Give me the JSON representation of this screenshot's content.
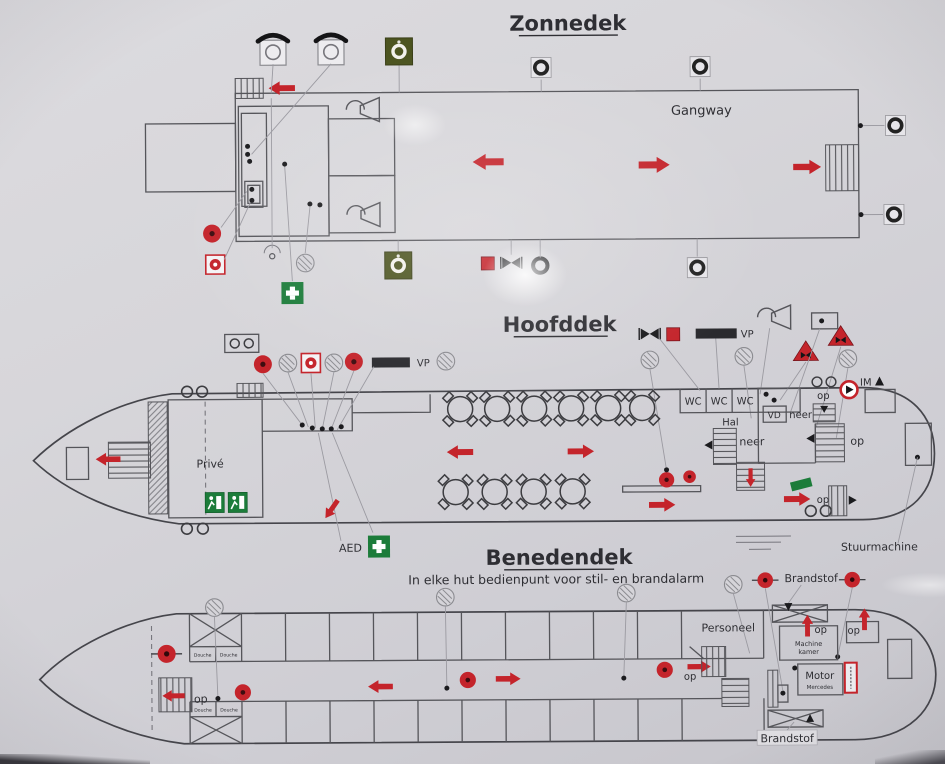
{
  "photo": {
    "paper_color": "#d7d6da"
  },
  "colors": {
    "plan_line": "#55555a",
    "alarm_red": "#c4242b",
    "safety_green": "#1c7c3a",
    "buoy_sign_olive": "#4c5420",
    "callout_gray": "#9b9aa1"
  },
  "icons": {
    "lifebuoy-icon": "black ring in square",
    "fire-bell-icon": "red alarm bell",
    "call-point-icon": "red manual call point",
    "smoke-detector-icon": "hatched circle detector",
    "telephone-icon": "handset over box",
    "lifebuoy-sign-icon": "olive square with white ring",
    "first-aid-icon": "green cross",
    "exit-sign-icon": "green running-man sign",
    "fire-valve-icon": "black bowtie valve",
    "triangle-valve-icon": "red triangle with valve",
    "horn-icon": "alarm horn",
    "fire-pump-icon": "red circle with triangle",
    "escape-arrow-icon": "red escape route arrow",
    "table-icon": "round table with four chairs",
    "stairs-icon": "hatched staircase"
  },
  "zonnedek": {
    "title": "Zonnedek",
    "gangway": "Gangway"
  },
  "hoofddek": {
    "title": "Hoofddek",
    "prive": "Privé",
    "wc": "WC",
    "hal": "Hal",
    "neer": "neer",
    "op": "op",
    "vd": "VD",
    "vp": "VP",
    "im": "IM",
    "aed": "AED",
    "stuurmachine": "Stuurmachine"
  },
  "benedendek": {
    "title": "Benedendek",
    "subtitle": "In elke hut bedienpunt voor stil- en brandalarm",
    "personeel": "Personeel",
    "brandstof": "Brandstof",
    "machine": "Machine",
    "kamer": "kamer",
    "motor": "Motor",
    "motor_type": "Mercedes",
    "douche": "Douche",
    "op": "op"
  }
}
